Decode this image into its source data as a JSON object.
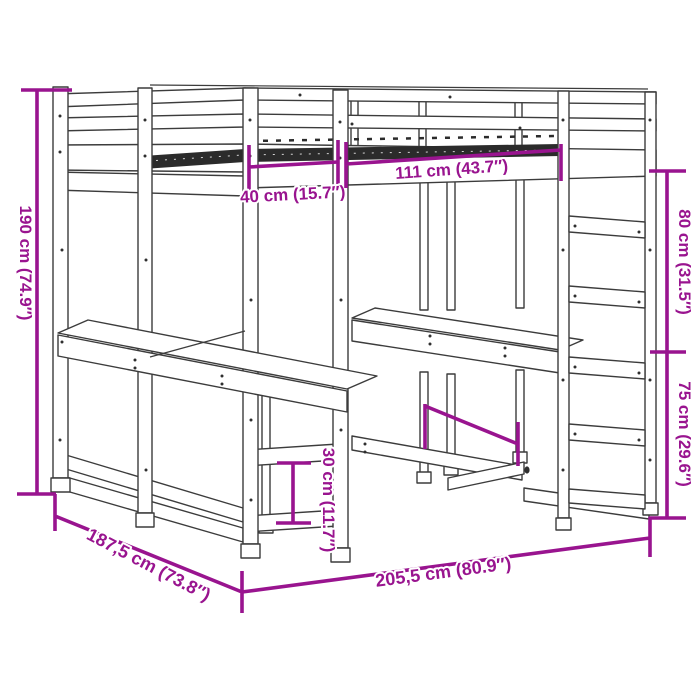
{
  "title": "Loft bed with desks and ladder dimension diagram",
  "colors": {
    "accent": "#99148F",
    "line": "#3C3C3C",
    "slats": "#2B2B2B",
    "background": "#FFFFFF"
  },
  "dims": {
    "d190": {
      "label": "190 cm (74.9″)"
    },
    "d40": {
      "label": "40 cm (15.7″)"
    },
    "d111": {
      "label": "111 cm (43.7″)"
    },
    "d80": {
      "label": "80 cm (31.5″)"
    },
    "d75": {
      "label": "75 cm (29.6″)"
    },
    "d30": {
      "label": "30 cm (11.7″)"
    },
    "d187": {
      "label": "187,5 cm (73.8″)"
    },
    "d205": {
      "label": "205,5 cm (80.9″)"
    }
  }
}
